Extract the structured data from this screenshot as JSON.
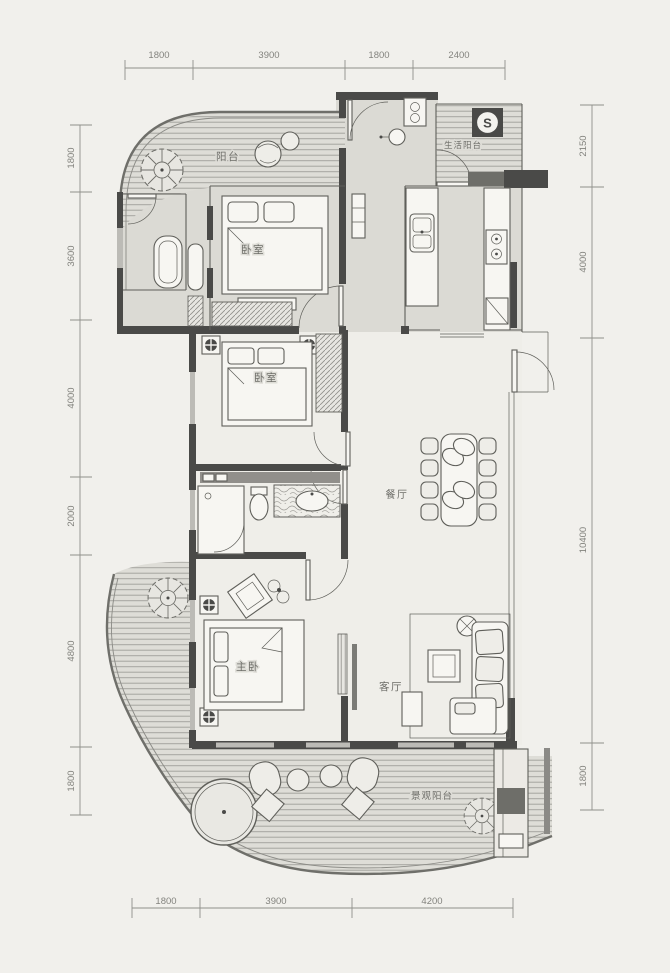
{
  "rooms": {
    "balcony_top": "阳台",
    "bedroom_top": "卧室",
    "service_balcony": "生活阳台",
    "bedroom_mid": "卧室",
    "dining": "餐厅",
    "master_bedroom": "主卧",
    "living_room": "客厅",
    "view_balcony": "景观阳台"
  },
  "dimensions": {
    "top": [
      "1800",
      "3900",
      "1800",
      "2400"
    ],
    "bottom": [
      "1800",
      "3900",
      "4200"
    ],
    "left": [
      "1800",
      "3600",
      "4000",
      "2000",
      "4800",
      "1800"
    ],
    "right": [
      "2150",
      "4000",
      "10400",
      "1800"
    ]
  },
  "icons": {
    "water_heater_glyph": "S"
  },
  "colors": {
    "paper": "#f1f0ec",
    "tint": "#dbdad4",
    "room": "#eeede8",
    "wall": "#4a4a48",
    "line": "#5f5f5a",
    "stripe": "#a6a5a0",
    "window": "#bcbbb6",
    "text": "#6d6d68",
    "dim": "#83837e"
  }
}
